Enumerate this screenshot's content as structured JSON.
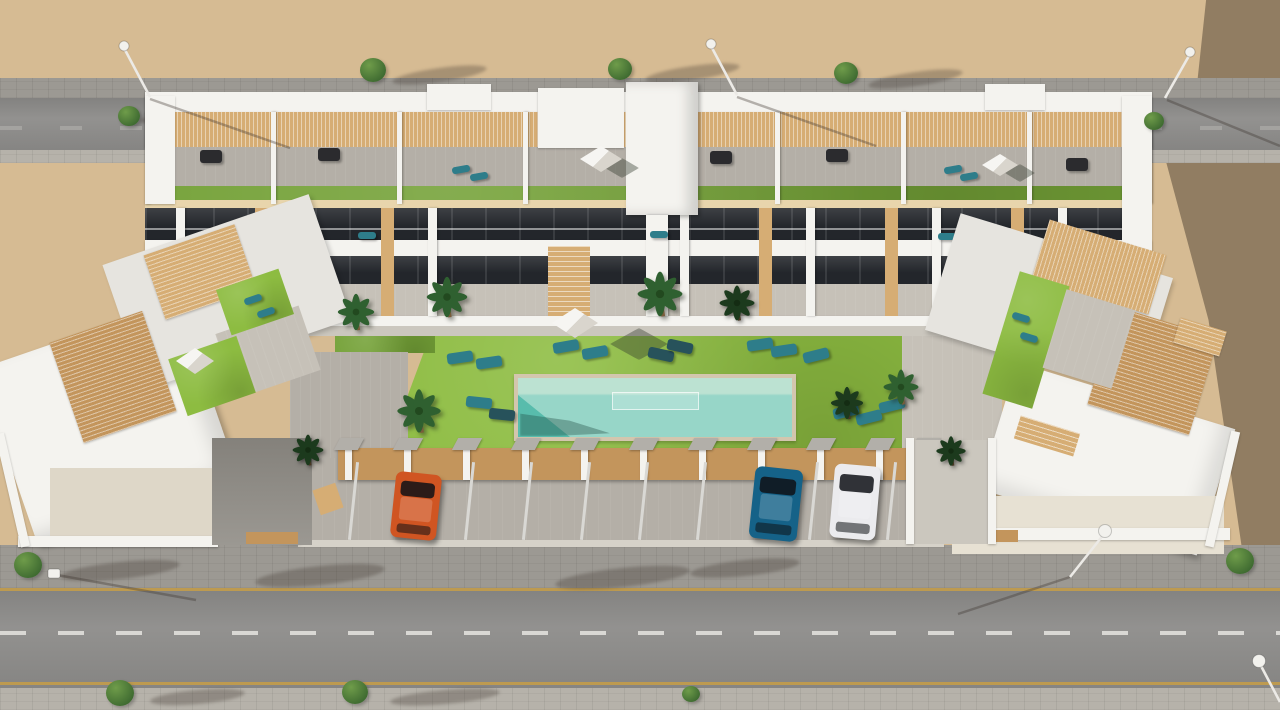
{
  "meta": {
    "title": "Aerial 3D architectural rendering of a white residential apartment complex",
    "view": "top-down aerial perspective, CGI visualization",
    "canvas": {
      "width": 1280,
      "height": 710
    }
  },
  "palette": {
    "sand": "#d6bb93",
    "shadow": "#40342a",
    "road": "#8e8d8b",
    "road-edge": "#7c7b79",
    "sidewalk-dark": "#9c9993",
    "sidewalk-light": "#b6b2aa",
    "curb": "#d6d2c9",
    "yellow-line": "#bd9a50",
    "white-line": "#d9d8d4",
    "dash-faint": "#adaca8",
    "white": "#f4f3ef",
    "white-shade": "#e6e4df",
    "white-dim": "#d2cfc9",
    "glass": "#23262b",
    "cream": "#e8d5ac",
    "wood": "#d6ad74",
    "wood-dark": "#c3955c",
    "paver": "#b4afa7",
    "paver-light": "#c6c1b8",
    "path": "#cbc7be",
    "grass": "#8dbc41",
    "grass-dark": "#74a137",
    "pool-border": "#d3c6ae",
    "pool-shelf": "#bce2d2",
    "pool-main": "#97d6c8",
    "pool-deep": "#58bcac",
    "lounger": "#2e7d8a",
    "lounger-dark": "#27525b",
    "car-black": "#17171c",
    "car-orange": "#d05522",
    "car-blue": "#156288",
    "car-white": "#ebebee",
    "palm": "#2f6030",
    "palm-trunk": "#7a5c3a",
    "bush-light": "#6f9c4a",
    "bush-dark": "#3f6b31",
    "lamp": "#f1efe9"
  },
  "scene": {
    "environment": {
      "ground": "desert sand",
      "streets": [
        "top horizontal street with sidewalks",
        "bottom horizontal street with sidewalks"
      ],
      "road_markings": [
        "yellow edge lines (bottom street)",
        "white dashed center lines"
      ],
      "street_lamps": 6,
      "bushes": 10,
      "cast_shadows": "building shadows on sand at right side"
    },
    "buildings": {
      "north_row": {
        "levels": [
          "roof solarium with wooden pergolas and terraces",
          "upper floor with glazed balconies",
          "ground floor terraces"
        ],
        "pergola_material": "light wood slats",
        "units_visible": 8,
        "stair_tower": "central white elevator/stair tower",
        "roof_furniture": [
          "dining sets",
          "sun loungers",
          "white parasols"
        ]
      },
      "west_wing": "L-shaped white block with wood pergolas, green roof gardens, parasol and patio",
      "east_wing": "L-shaped white block with wood pergolas, green roof strip, wooden stair and patio"
    },
    "amenities": {
      "pool": {
        "shape": "rectangular",
        "water": "turquoise",
        "features": [
          "shallow shelf",
          "corner steps",
          "splash platform outline"
        ]
      },
      "lawn": "central communal garden",
      "sun_loungers": 20,
      "parasols": 4,
      "palm_trees": 9
    },
    "parking": {
      "spaces_marked": 10,
      "back_wall": "ochre wall with white pillars and grey caps",
      "cars": [
        {
          "name": "black-car"
        },
        {
          "name": "orange-car"
        },
        {
          "name": "blue-car"
        },
        {
          "name": "white-car"
        }
      ]
    }
  }
}
